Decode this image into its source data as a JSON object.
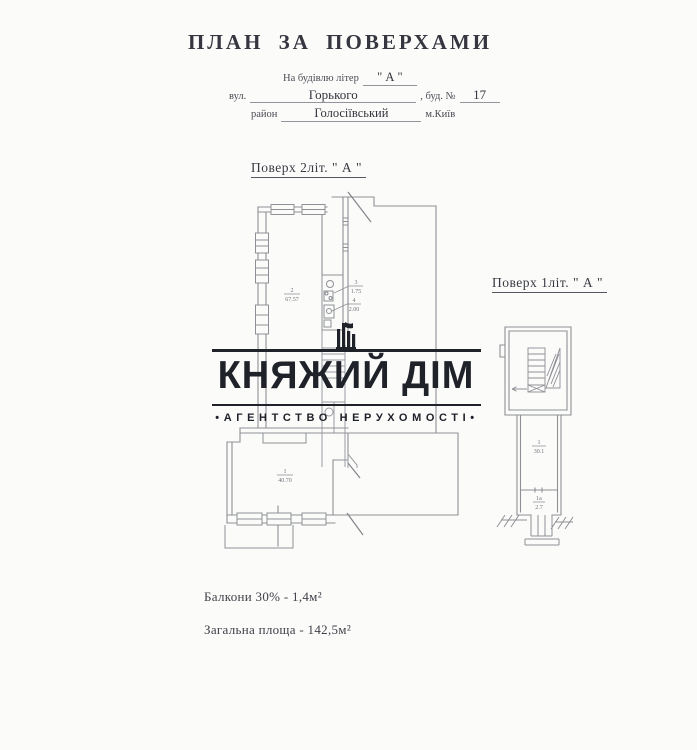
{
  "header": {
    "title": "ПЛАН ЗА ПОВЕРХАМИ",
    "building_label": "На будівлю літер",
    "building_letter": "\" А \"",
    "street_label": "вул.",
    "street_value": "Горького",
    "bld_label": ", буд. №",
    "bld_value": "17",
    "district_label": "район",
    "district_value": "Голосіївський",
    "city_label": "м.Київ"
  },
  "plans": {
    "floor2": {
      "label": "Поверх  2літ. \" А \"",
      "room2_num": "2",
      "room2_area": "67.57",
      "room3_num": "3",
      "room3_area": "1.75",
      "room4_num": "4",
      "room4_area": "2.00",
      "room1_num": "1",
      "room1_area": "40.70"
    },
    "floor1": {
      "label": "Поверх  1літ. \" А \"",
      "hall_num": "1",
      "hall_area": "30.1",
      "entry_num": "1а",
      "entry_area": "2.7"
    }
  },
  "watermark": {
    "brand": "КНЯЖИЙ ДІМ",
    "tagline": "•АГЕНТСТВО  НЕРУХОМОСТІ•",
    "color": "#20222a"
  },
  "notes": {
    "balcony": "Балкони 30% - 1,4м²",
    "total": "Загальна площа - 142,5м²"
  },
  "colors": {
    "plan_line": "#8f9096",
    "paper": "#fbfbfa",
    "text": "#3a3b45"
  }
}
